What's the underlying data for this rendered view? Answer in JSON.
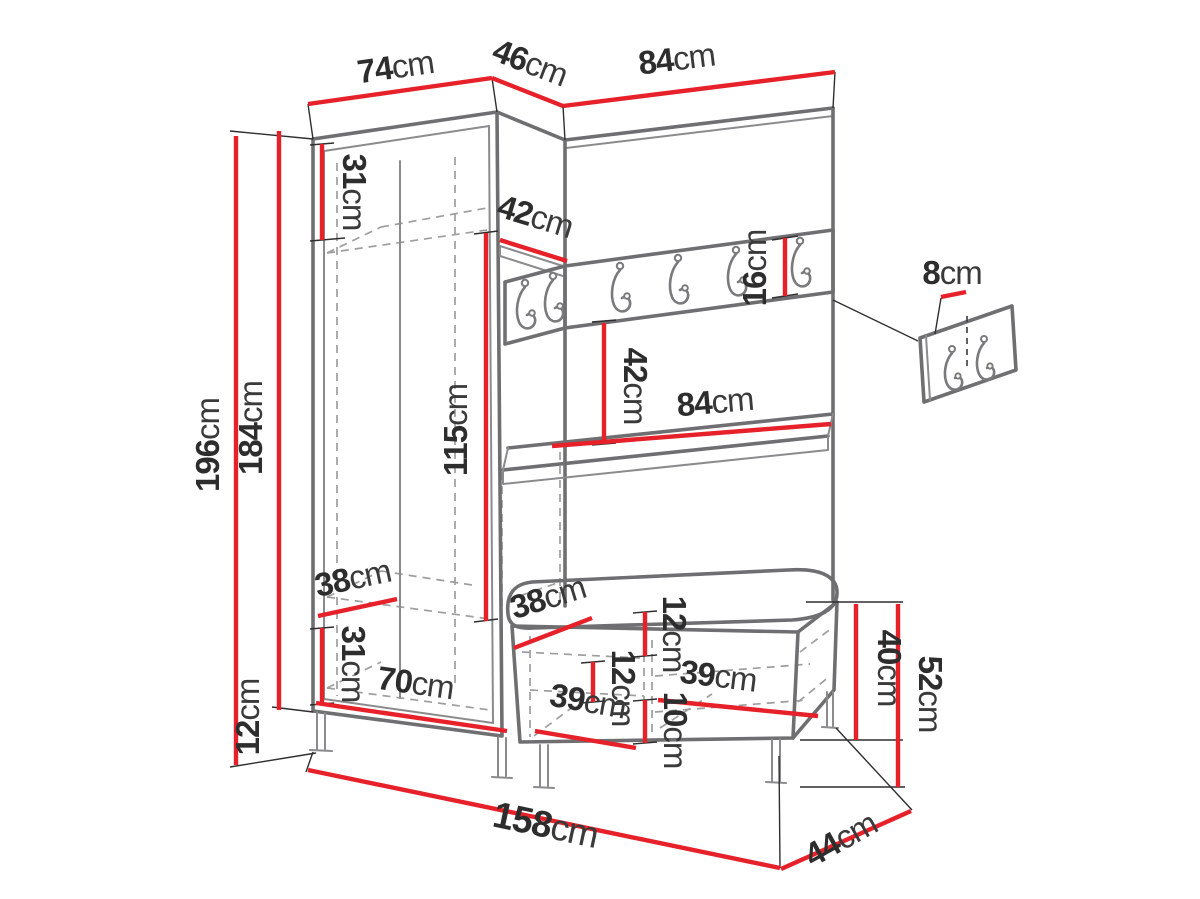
{
  "diagram": {
    "description": "Hallway furniture set technical drawing with dimensions",
    "colors": {
      "dimension_line": "#E62129",
      "outline": "#6f6f71",
      "hidden_line": "#9e9e9e",
      "text": "#2d2d2d"
    },
    "labels": {
      "top_left_width": {
        "value": "74",
        "unit": "cm"
      },
      "corner_width": {
        "value": "46",
        "unit": "cm"
      },
      "top_right_width": {
        "value": "84",
        "unit": "cm"
      },
      "total_height": {
        "value": "196",
        "unit": "cm"
      },
      "body_height": {
        "value": "184",
        "unit": "cm"
      },
      "leg_height": {
        "value": "12",
        "unit": "cm"
      },
      "top_shelf_height": {
        "value": "31",
        "unit": "cm"
      },
      "hanging_space_height": {
        "value": "115",
        "unit": "cm"
      },
      "corner_shelf_depth": {
        "value": "42",
        "unit": "cm"
      },
      "hook_rail_height": {
        "value": "16",
        "unit": "cm"
      },
      "open_gap_height": {
        "value": "42",
        "unit": "cm"
      },
      "shelf_width": {
        "value": "84",
        "unit": "cm"
      },
      "wardrobe_depth": {
        "value": "38",
        "unit": "cm"
      },
      "bottom_section_height": {
        "value": "31",
        "unit": "cm"
      },
      "wardrobe_inner_width": {
        "value": "70",
        "unit": "cm"
      },
      "bench_depth": {
        "value": "38",
        "unit": "cm"
      },
      "bench_top_height": {
        "value": "12",
        "unit": "cm"
      },
      "drawer_height": {
        "value": "12",
        "unit": "cm"
      },
      "left_compartment_width": {
        "value": "39",
        "unit": "cm"
      },
      "lower_drawer_height": {
        "value": "10",
        "unit": "cm"
      },
      "right_compartment_width": {
        "value": "39",
        "unit": "cm"
      },
      "bench_body_height": {
        "value": "40",
        "unit": "cm"
      },
      "bench_total_height": {
        "value": "52",
        "unit": "cm"
      },
      "total_width": {
        "value": "158",
        "unit": "cm"
      },
      "bench_total_depth": {
        "value": "44",
        "unit": "cm"
      },
      "hook_offset": {
        "value": "8",
        "unit": "cm"
      }
    }
  }
}
